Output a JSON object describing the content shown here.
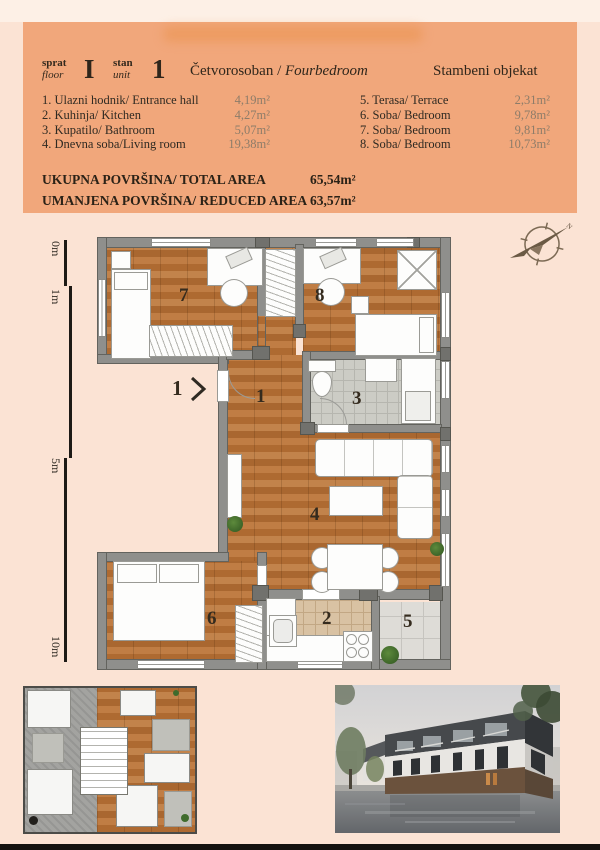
{
  "header": {
    "floor_label_top": "sprat",
    "floor_label_bottom": "floor",
    "floor_value": "I",
    "unit_label_top": "stan",
    "unit_label_bottom": "unit",
    "unit_value": "1",
    "apartment_type_sr": "Četvorosoban /",
    "apartment_type_en": "Fourbedroom",
    "building_label": "Stambeni objekat",
    "rooms_left": [
      {
        "name": "1. Ulazni hodnik/ Entrance hall",
        "area": "4,19m²"
      },
      {
        "name": "2. Kuhinja/ Kitchen",
        "area": "4,27m²"
      },
      {
        "name": "3. Kupatilo/ Bathroom",
        "area": "5,07m²"
      },
      {
        "name": "4. Dnevna soba/Living room",
        "area": "19,38m²"
      }
    ],
    "rooms_right": [
      {
        "name": "5. Terasa/ Terrace",
        "area": "2,31m²"
      },
      {
        "name": "6. Soba/ Bedroom",
        "area": "9,78m²"
      },
      {
        "name": "7. Soba/ Bedroom",
        "area": "9,81m²"
      },
      {
        "name": "8. Soba/ Bedroom",
        "area": "10,73m²"
      }
    ],
    "total_label": "UKUPNA POVRŠINA/ TOTAL AREA",
    "total_value": "65,54m²",
    "reduced_label": "UMANJENA POVRŠINA/ REDUCED AREA",
    "reduced_value": "63,57m²"
  },
  "plan": {
    "scale_labels": [
      "0m",
      "1m",
      "5m",
      "10m"
    ],
    "entrance_label": "1",
    "compass_label": "N",
    "numbers": {
      "hall": "1",
      "kitchen": "2",
      "bath": "3",
      "living": "4",
      "terrace": "5",
      "bed6": "6",
      "bed7": "7",
      "bed8": "8"
    }
  },
  "colors": {
    "page_bg": "#fbe3d4",
    "header_bg": "#f1a77b",
    "text": "#33291d",
    "muted_area": "#8d7c69",
    "wood": "#b5743c",
    "wall": "#8f8f8c"
  }
}
